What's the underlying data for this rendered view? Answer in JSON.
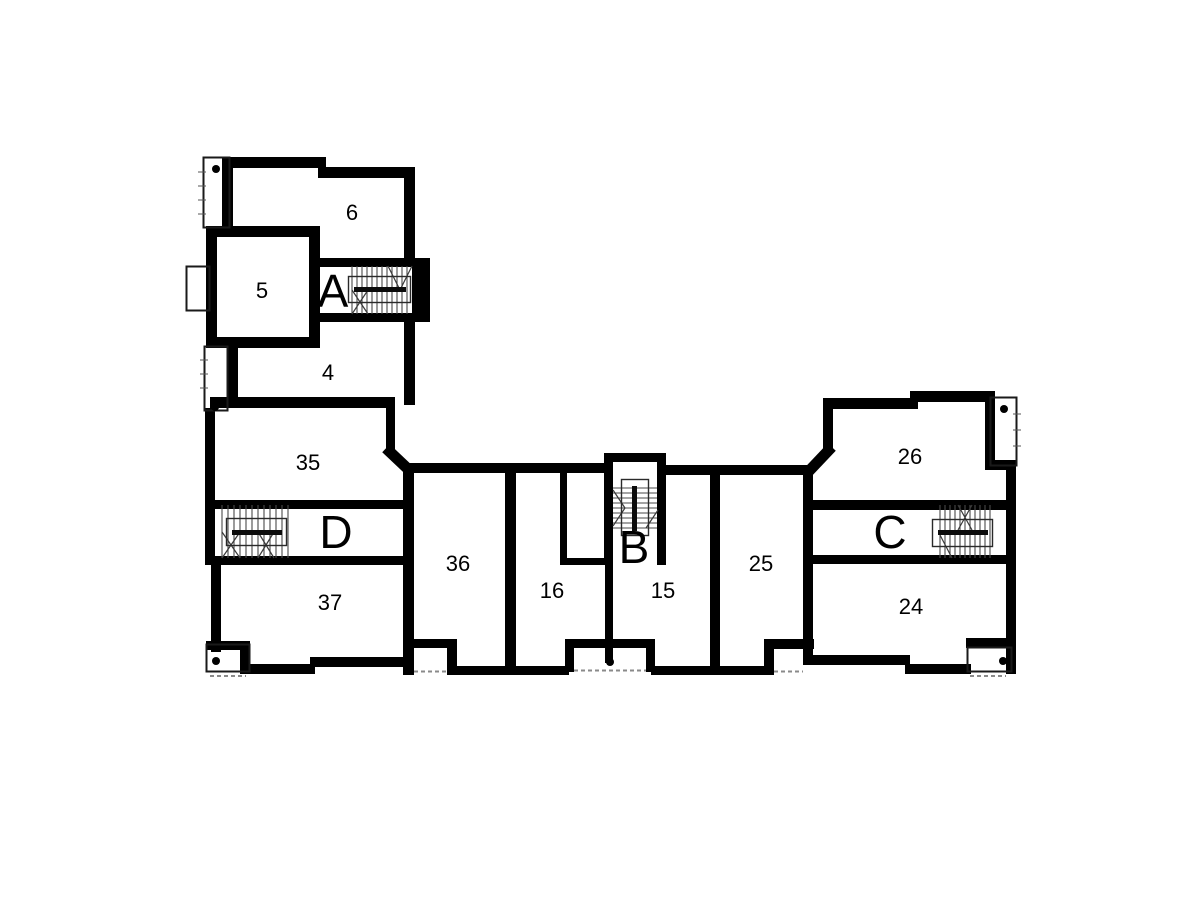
{
  "page": {
    "background": "#ffffff"
  },
  "plan": {
    "type": "architectural floor plan",
    "wall_color": "#000000",
    "rooms": {
      "r6": "6",
      "r5": "5",
      "r4": "4",
      "r35": "35",
      "r37": "37",
      "r36": "36",
      "r16": "16",
      "r15": "15",
      "r25": "25",
      "r26": "26",
      "r24": "24"
    },
    "stairwells": {
      "a": "A",
      "b": "B",
      "c": "C",
      "d": "D"
    }
  }
}
